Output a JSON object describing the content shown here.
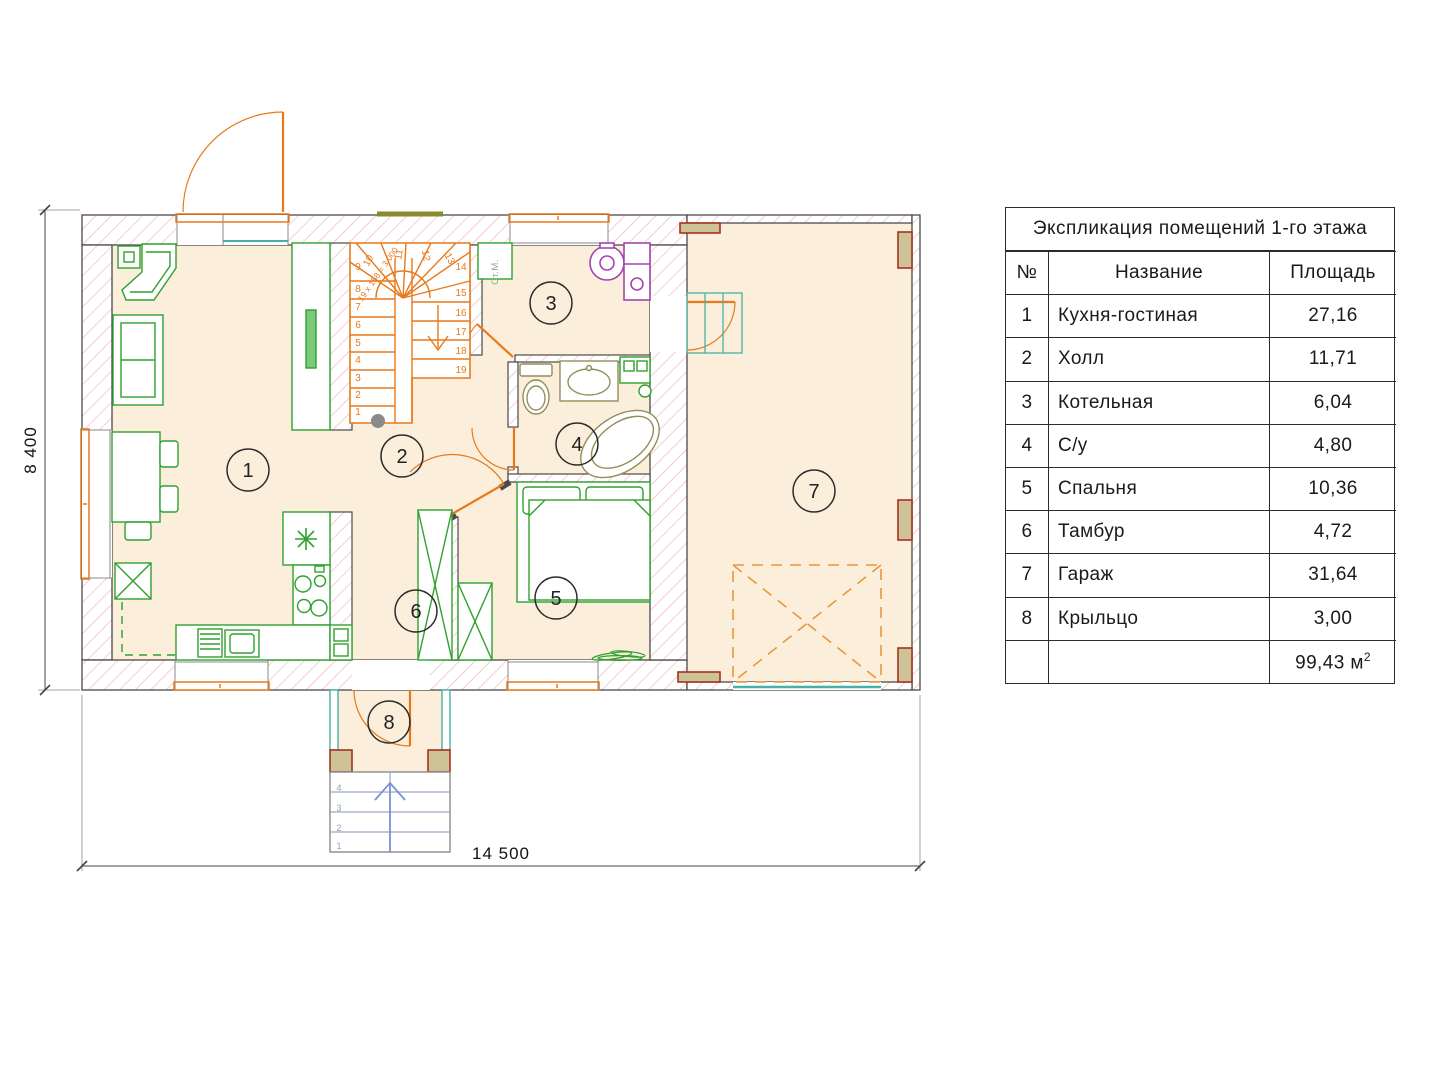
{
  "legend_table": {
    "title": "Экспликация помещений 1-го этажа",
    "columns": {
      "num": "№",
      "name": "Название",
      "area": "Площадь"
    },
    "rows": [
      {
        "num": "1",
        "name": "Кухня-гостиная",
        "area": "27,16"
      },
      {
        "num": "2",
        "name": "Холл",
        "area": "11,71"
      },
      {
        "num": "3",
        "name": "Котельная",
        "area": "6,04"
      },
      {
        "num": "4",
        "name": "С/у",
        "area": "4,80"
      },
      {
        "num": "5",
        "name": "Спальня",
        "area": "10,36"
      },
      {
        "num": "6",
        "name": "Тамбур",
        "area": "4,72"
      },
      {
        "num": "7",
        "name": "Гараж",
        "area": "31,64"
      },
      {
        "num": "8",
        "name": "Крыльцо",
        "area": "3,00"
      }
    ],
    "total": {
      "value": "99,43",
      "unit": "м",
      "sup": "2"
    }
  },
  "plan": {
    "dim_width": "14 500",
    "dim_height": "8 400",
    "room_numbers": [
      "1",
      "2",
      "3",
      "4",
      "5",
      "6",
      "7",
      "8"
    ],
    "stair_steps": [
      "1",
      "2",
      "3",
      "4",
      "5",
      "6",
      "7",
      "8",
      "9",
      "10",
      "11",
      "12",
      "13",
      "14",
      "15",
      "16",
      "17",
      "18",
      "19"
    ],
    "stair_note": "19 х 158 = 3 000",
    "porch_steps": [
      "1",
      "2",
      "3",
      "4"
    ],
    "washer_label": "Ст.М."
  },
  "colors": {
    "floor": "#fbeeda",
    "hatch": "#f0b4b4",
    "wall_line": "#4a4a4a",
    "stairs_doors": "#e8791b",
    "furniture": "#2fa12f",
    "teal": "#49b0a5",
    "sanitary": "#948e5a",
    "boiler": "#a643ae",
    "porch_step_lines": "#9aa6c8",
    "porch_arrow": "#7a90d8",
    "pilaster_fill": "#cec397",
    "pilaster_line": "#a53122",
    "garage_dash": "#e8973f"
  }
}
